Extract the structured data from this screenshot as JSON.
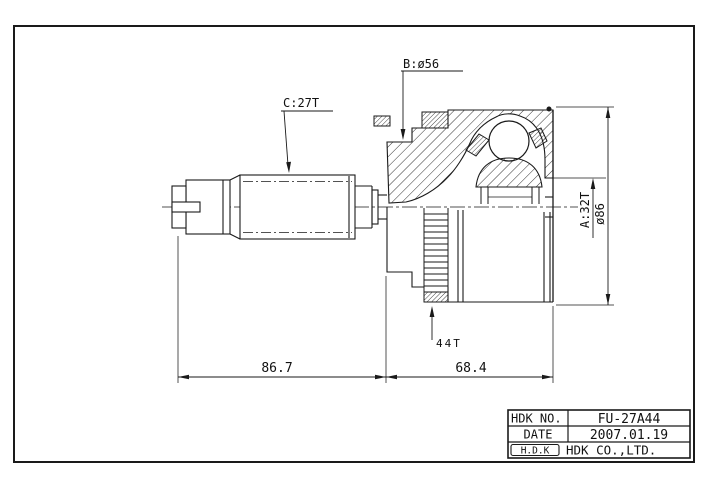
{
  "page": {
    "background": "#ffffff",
    "line_color": "#1a1a1a"
  },
  "drawing": {
    "callouts": {
      "b_boot_diameter": "B:ø56",
      "c_shaft_spline": "C:27T",
      "a_inner_spline": "A:32T",
      "outer_diameter": "ø86",
      "tone_ring": "44T"
    },
    "dimensions": {
      "shaft_section_length": "86.7",
      "joint_section_length": "68.4"
    }
  },
  "title_block": {
    "hdk_no_label": "HDK NO.",
    "hdk_no_value": "FU-27A44",
    "date_label": "DATE",
    "date_value": "2007.01.19",
    "logo": "H.D.K",
    "company": "HDK CO.,LTD."
  }
}
